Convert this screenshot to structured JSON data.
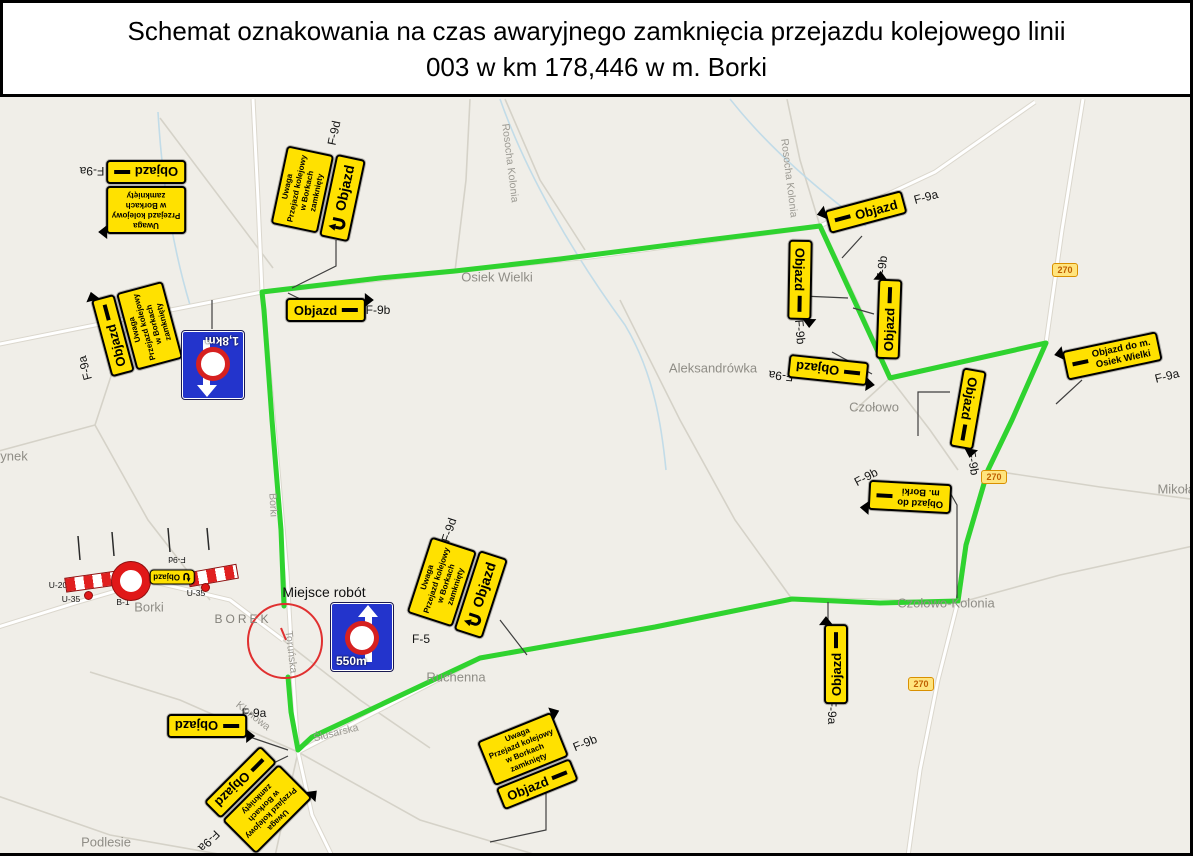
{
  "title": {
    "line1": "Schemat oznakowania na czas awaryjnego zamknięcia przejazdu kolejowego linii",
    "line2": "003 w km 178,446 w m. Borki"
  },
  "colors": {
    "route_green": "#2fd32f",
    "sign_yellow": "#ffe100",
    "sign_blue": "#2334cc",
    "barrier_red": "#e01818",
    "badge_bg": "#ffe47e",
    "badge_text": "#c05f00",
    "map_bg": "#f0eee8"
  },
  "annotations": {
    "worksite": "Miejsce robót"
  },
  "sign_text": {
    "objazd": "Objazd",
    "uwaga": [
      "Uwaga",
      "Przejazd kolejowy",
      "w Borkach",
      "zamknięty"
    ],
    "dest_osiek": [
      "Objazd do m.",
      "Osiek Wielki"
    ],
    "dest_borki": [
      "Objazd do",
      "m. Borki"
    ],
    "f5_distance_north": "1,8km",
    "f5_distance_south": "550m",
    "road_number": "270"
  },
  "place_labels": [
    {
      "name": "rosocha-kolonia-west",
      "text": "Rosocha Kolonia",
      "x": 510,
      "y": 163,
      "rot": 83,
      "cls": "street"
    },
    {
      "name": "rosocha-kolonia-east",
      "text": "Rosocha Kolonia",
      "x": 789,
      "y": 178,
      "rot": 83,
      "cls": "street"
    },
    {
      "name": "osiek-wielki",
      "text": "Osiek Wielki",
      "x": 497,
      "y": 277,
      "rot": 0,
      "cls": ""
    },
    {
      "name": "aleksandrowka",
      "text": "Aleksandrówka",
      "x": 713,
      "y": 368,
      "rot": 0,
      "cls": ""
    },
    {
      "name": "czolowo",
      "text": "Czołowo",
      "x": 874,
      "y": 407,
      "rot": 0,
      "cls": ""
    },
    {
      "name": "mikolaj",
      "text": "Mikołajew",
      "x": 1186,
      "y": 489,
      "rot": 0,
      "cls": ""
    },
    {
      "name": "czolowo-kolonia",
      "text": "Czołowo-Kolonia",
      "x": 946,
      "y": 603,
      "rot": 0,
      "cls": ""
    },
    {
      "name": "ruchenna",
      "text": "Ruchenna",
      "x": 456,
      "y": 677,
      "rot": 0,
      "cls": ""
    },
    {
      "name": "borek",
      "text": "BOREK",
      "x": 243,
      "y": 619,
      "rot": 0,
      "cls": "district"
    },
    {
      "name": "borki-village",
      "text": "Borki",
      "x": 149,
      "y": 607,
      "rot": 0,
      "cls": ""
    },
    {
      "name": "podlesie",
      "text": "Podlesie",
      "x": 106,
      "y": 842,
      "rot": 0,
      "cls": ""
    },
    {
      "name": "rynek-partial",
      "text": "ynek",
      "x": 14,
      "y": 456,
      "rot": 0,
      "cls": ""
    },
    {
      "name": "street-borki",
      "text": "Borki",
      "x": 273,
      "y": 505,
      "rot": 87,
      "cls": "street"
    },
    {
      "name": "street-torunska",
      "text": "Toruńska",
      "x": 291,
      "y": 652,
      "rot": 83,
      "cls": "street"
    },
    {
      "name": "street-klonowa",
      "text": "Klonowa",
      "x": 253,
      "y": 716,
      "rot": 38,
      "cls": "street"
    },
    {
      "name": "street-slusarska",
      "text": "Ślusarska",
      "x": 336,
      "y": 733,
      "rot": -14,
      "cls": "street"
    }
  ],
  "ref_labels": [
    {
      "text": "F-9a",
      "x": 92,
      "y": 171,
      "rot": 180,
      "small": false
    },
    {
      "text": "F-9d",
      "x": 334,
      "y": 133,
      "rot": -78,
      "small": false
    },
    {
      "text": "F-9b",
      "x": 378,
      "y": 310,
      "rot": 0,
      "small": false
    },
    {
      "text": "F-9a",
      "x": 85,
      "y": 368,
      "rot": -105,
      "small": false
    },
    {
      "text": "F-5",
      "x": 169,
      "y": 352,
      "rot": -105,
      "small": false
    },
    {
      "text": "F-9a",
      "x": 926,
      "y": 197,
      "rot": -15,
      "small": false
    },
    {
      "text": "F-9b",
      "x": 800,
      "y": 332,
      "rot": 85,
      "small": false
    },
    {
      "text": "F-9b",
      "x": 882,
      "y": 268,
      "rot": -85,
      "small": false
    },
    {
      "text": "F-9a",
      "x": 781,
      "y": 376,
      "rot": 186,
      "small": false
    },
    {
      "text": "F-9b",
      "x": 973,
      "y": 463,
      "rot": 80,
      "small": false
    },
    {
      "text": "F-9a",
      "x": 1167,
      "y": 376,
      "rot": -14,
      "small": false
    },
    {
      "text": "F-9b",
      "x": 866,
      "y": 477,
      "rot": -28,
      "small": false
    },
    {
      "text": "F-5",
      "x": 421,
      "y": 639,
      "rot": 0,
      "small": false
    },
    {
      "text": "F-9d",
      "x": 449,
      "y": 530,
      "rot": -72,
      "small": false
    },
    {
      "text": "F-9a",
      "x": 832,
      "y": 712,
      "rot": 90,
      "small": false
    },
    {
      "text": "F-9a",
      "x": 254,
      "y": 713,
      "rot": 0,
      "small": false
    },
    {
      "text": "F-9a",
      "x": 209,
      "y": 841,
      "rot": 135,
      "small": false
    },
    {
      "text": "F-9b",
      "x": 585,
      "y": 743,
      "rot": -22,
      "small": false
    },
    {
      "text": "B-1",
      "x": 123,
      "y": 602,
      "rot": 0,
      "small": true
    },
    {
      "text": "U-35",
      "x": 71,
      "y": 599,
      "rot": 0,
      "small": true
    },
    {
      "text": "U-35",
      "x": 196,
      "y": 593,
      "rot": 0,
      "small": true
    },
    {
      "text": "U-20",
      "x": 58,
      "y": 585,
      "rot": 0,
      "small": true
    },
    {
      "text": "F-9d",
      "x": 177,
      "y": 560,
      "rot": 180,
      "small": true
    }
  ],
  "road_badges": [
    {
      "x": 1065,
      "y": 270
    },
    {
      "x": 994,
      "y": 477
    },
    {
      "x": 921,
      "y": 684
    }
  ],
  "clusters": [
    {
      "name": "cluster-nw-f9a",
      "x": 146,
      "y": 197,
      "rot": 180,
      "parts": [
        {
          "t": "uwaga"
        },
        {
          "t": "objazd",
          "arrow": "right"
        }
      ]
    },
    {
      "name": "cluster-n-f9d",
      "x": 318,
      "y": 193,
      "rot": -78,
      "parts": [
        {
          "t": "uwaga"
        },
        {
          "t": "uturn"
        }
      ]
    },
    {
      "name": "sign-f9b-osiek",
      "x": 326,
      "y": 310,
      "rot": 0,
      "parts": [
        {
          "t": "objazd",
          "arrow": "right"
        }
      ]
    },
    {
      "name": "cluster-w-f9a",
      "x": 137,
      "y": 329,
      "rot": -105,
      "parts": [
        {
          "t": "objazd",
          "arrow": "right"
        },
        {
          "t": "uwaga"
        }
      ]
    },
    {
      "name": "sign-f5-north",
      "x": 213,
      "y": 365,
      "rot": 180,
      "parts": [
        {
          "t": "f5",
          "dist": "f5_distance_north"
        }
      ]
    },
    {
      "name": "sign-f9a-ne",
      "x": 866,
      "y": 212,
      "rot": -15,
      "parts": [
        {
          "t": "objazd",
          "arrow": "left"
        }
      ]
    },
    {
      "name": "sign-f9b-vert-west",
      "x": 800,
      "y": 280,
      "rot": 91,
      "parts": [
        {
          "t": "objazd",
          "arrow": "right"
        }
      ]
    },
    {
      "name": "sign-f9b-vert-east",
      "x": 889,
      "y": 319,
      "rot": -88,
      "parts": [
        {
          "t": "objazd",
          "arrow": "right"
        }
      ]
    },
    {
      "name": "sign-f9a-czolowo",
      "x": 828,
      "y": 370,
      "rot": 186,
      "parts": [
        {
          "t": "objazd",
          "arrow": "left"
        }
      ]
    },
    {
      "name": "sign-f9b-vert-270",
      "x": 968,
      "y": 409,
      "rot": 100,
      "parts": [
        {
          "t": "objazd",
          "arrow": "right"
        }
      ]
    },
    {
      "name": "sign-dest-osiek",
      "x": 1112,
      "y": 356,
      "rot": -12,
      "parts": [
        {
          "t": "dest",
          "lines": "dest_osiek",
          "arrow": "left"
        }
      ]
    },
    {
      "name": "sign-dest-borki",
      "x": 910,
      "y": 497,
      "rot": 183,
      "parts": [
        {
          "t": "dest",
          "lines": "dest_borki",
          "arrow": "right"
        }
      ]
    },
    {
      "name": "cluster-center-f9d",
      "x": 457,
      "y": 587,
      "rot": -72,
      "parts": [
        {
          "t": "uwaga"
        },
        {
          "t": "uturn"
        }
      ]
    },
    {
      "name": "sign-f9a-vert-south",
      "x": 836,
      "y": 664,
      "rot": -90,
      "parts": [
        {
          "t": "objazd",
          "arrow": "right"
        }
      ]
    },
    {
      "name": "sign-f9a-sw",
      "x": 207,
      "y": 726,
      "rot": 180,
      "parts": [
        {
          "t": "objazd",
          "arrow": "left"
        }
      ]
    },
    {
      "name": "cluster-sw-f9a",
      "x": 258,
      "y": 800,
      "rot": 135,
      "parts": [
        {
          "t": "uwaga"
        },
        {
          "t": "objazd",
          "arrow": "left"
        }
      ]
    },
    {
      "name": "cluster-s-f9b",
      "x": 528,
      "y": 761,
      "rot": -22,
      "parts": [
        {
          "t": "uwaga"
        },
        {
          "t": "objazd",
          "arrow": "right"
        }
      ]
    },
    {
      "name": "sign-f5-south",
      "x": 362,
      "y": 637,
      "rot": 0,
      "parts": [
        {
          "t": "f5",
          "dist": "f5_distance_south"
        }
      ]
    },
    {
      "name": "sign-f9d-barrier",
      "x": 172,
      "y": 577,
      "rot": 180,
      "parts": [
        {
          "t": "objazd-mini"
        }
      ]
    }
  ]
}
